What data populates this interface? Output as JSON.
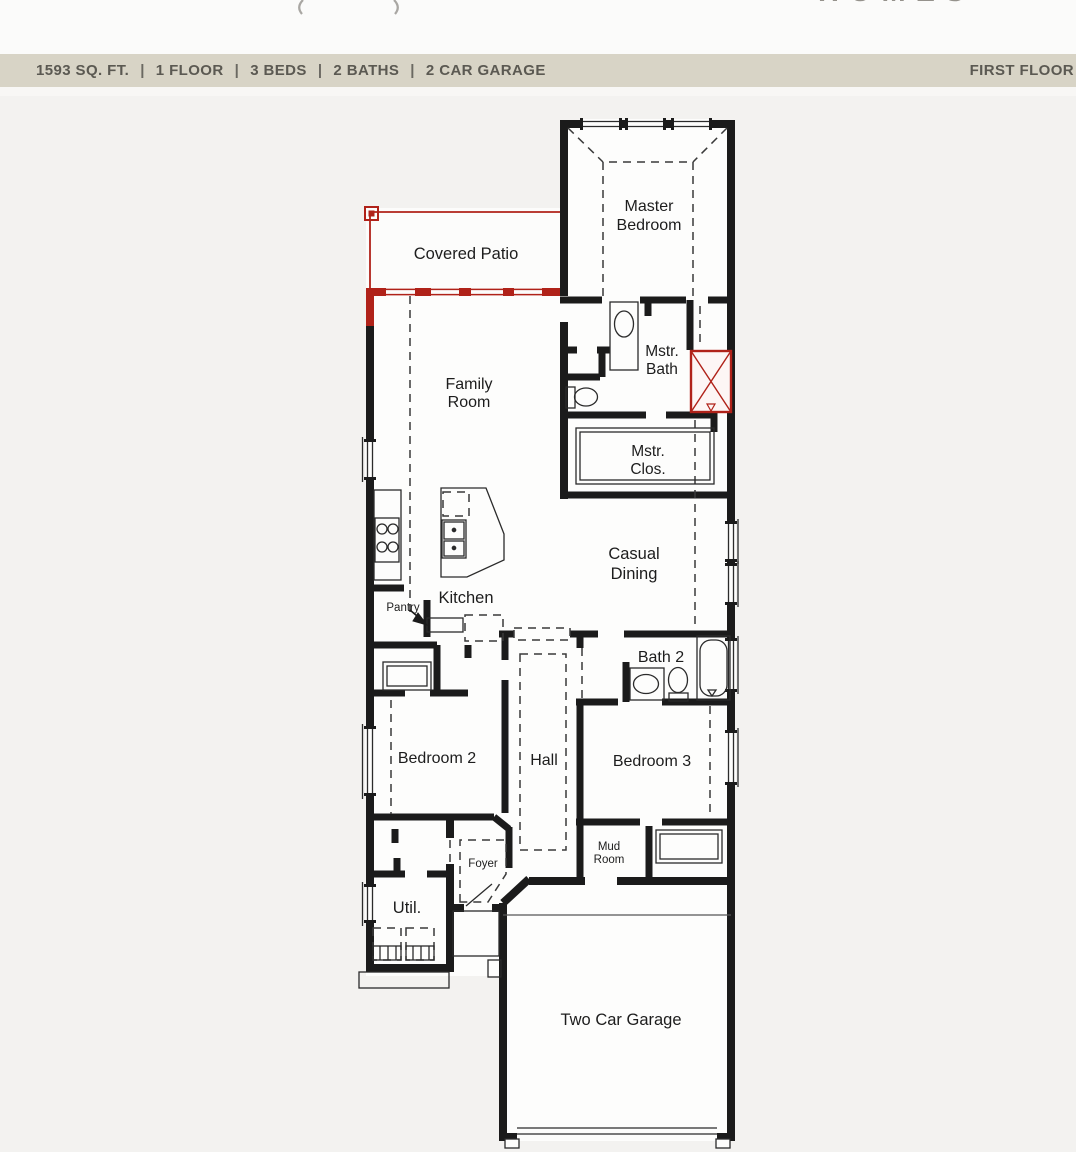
{
  "logo": {
    "partial_text": "HOMES"
  },
  "header": {
    "items": [
      "1593 SQ. FT.",
      "1 FLOOR",
      "3 BEDS",
      "2 BATHS",
      "2 CAR GARAGE"
    ],
    "separator": "|",
    "floor_label": "FIRST FLOOR"
  },
  "rooms": {
    "covered_patio": "Covered Patio",
    "master_bedroom": [
      "Master",
      "Bedroom"
    ],
    "master_bath": [
      "Mstr.",
      "Bath"
    ],
    "master_closet": [
      "Mstr.",
      "Clos."
    ],
    "family_room": [
      "Family",
      "Room"
    ],
    "kitchen": "Kitchen",
    "pantry": "Pantry",
    "casual_dining": [
      "Casual",
      "Dining"
    ],
    "bath_2": "Bath 2",
    "bedroom_2": "Bedroom 2",
    "hall": "Hall",
    "bedroom_3": "Bedroom 3",
    "mud_room": [
      "Mud",
      "Room"
    ],
    "foyer": "Foyer",
    "utility": "Util.",
    "garage": "Two Car Garage"
  },
  "colors": {
    "header_bar_bg": "#d8d4c6",
    "header_text": "#5b5952",
    "accent_red": "#b02219",
    "wall_black": "#1b1b1b",
    "page_bg": "#f3f2f0"
  }
}
